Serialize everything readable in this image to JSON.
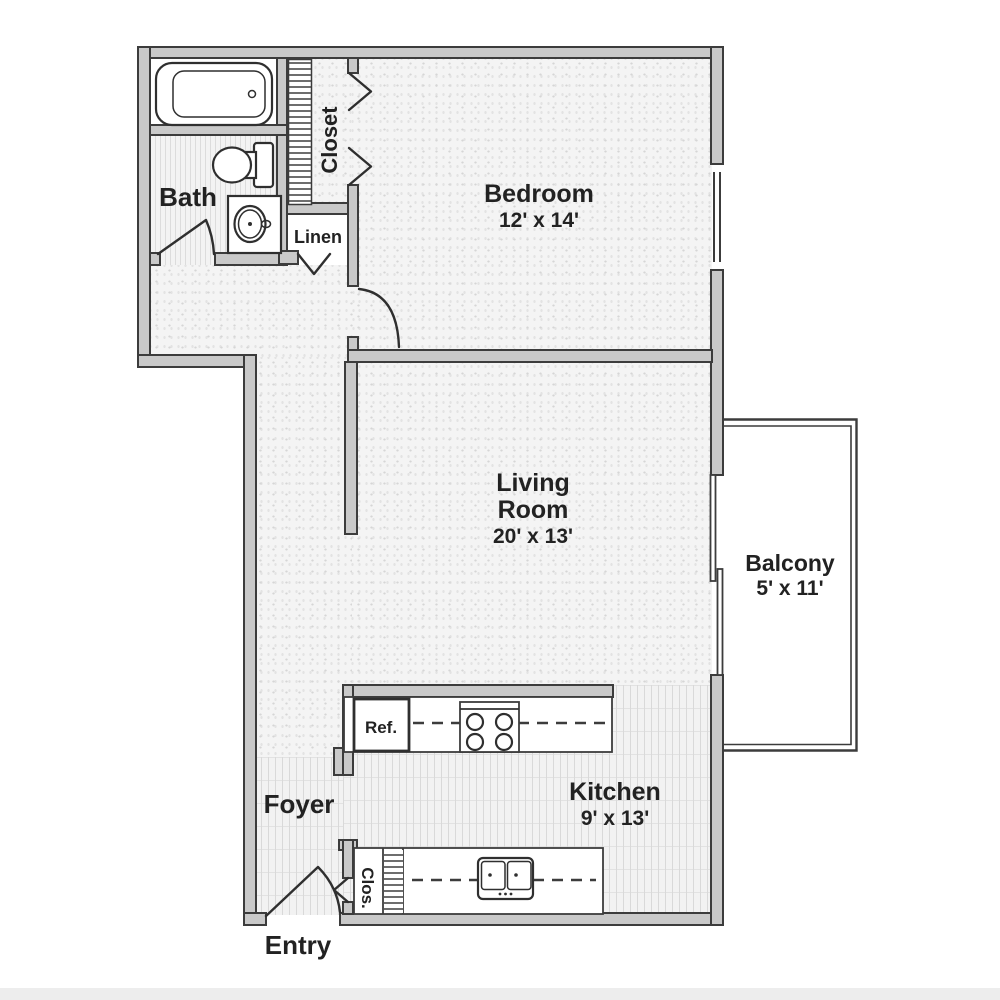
{
  "title": "One-bedroom apartment floor plan",
  "colors": {
    "background": "#ffffff",
    "wall_fill": "#c9c9c9",
    "wall_outline": "#3c3c3c",
    "floor_light": "#f3f3f3",
    "floor_stripe": "#d9d9d9",
    "text": "#222222"
  },
  "rooms": {
    "bath": {
      "label": "Bath"
    },
    "closet": {
      "label": "Closet"
    },
    "linen": {
      "label": "Linen"
    },
    "bedroom": {
      "label": "Bedroom",
      "dims": "12' x 14'"
    },
    "living": {
      "label_line1": "Living",
      "label_line2": "Room",
      "dims": "20' x 13'"
    },
    "balcony": {
      "label": "Balcony",
      "dims": "5' x 11'"
    },
    "kitchen": {
      "label": "Kitchen",
      "dims": "9' x 13'"
    },
    "foyer": {
      "label": "Foyer"
    },
    "entry": {
      "label": "Entry"
    },
    "entry_closet": {
      "label": "Clos."
    },
    "refrigerator": {
      "label": "Ref."
    }
  },
  "fixtures": {
    "bathtub": "bathtub-icon",
    "toilet": "toilet-icon",
    "vanity_sink": "vanity-sink-icon",
    "closet_shelves": "shelf-hatch-icon",
    "bifold_doors": "bifold-door-chevrons",
    "range": "four-burner-range-icon",
    "kitchen_sink": "double-basin-sink-icon",
    "sliding_door": "sliding-glass-door-icon",
    "window": "window-icon",
    "door_swing": "door-swing-icon"
  }
}
